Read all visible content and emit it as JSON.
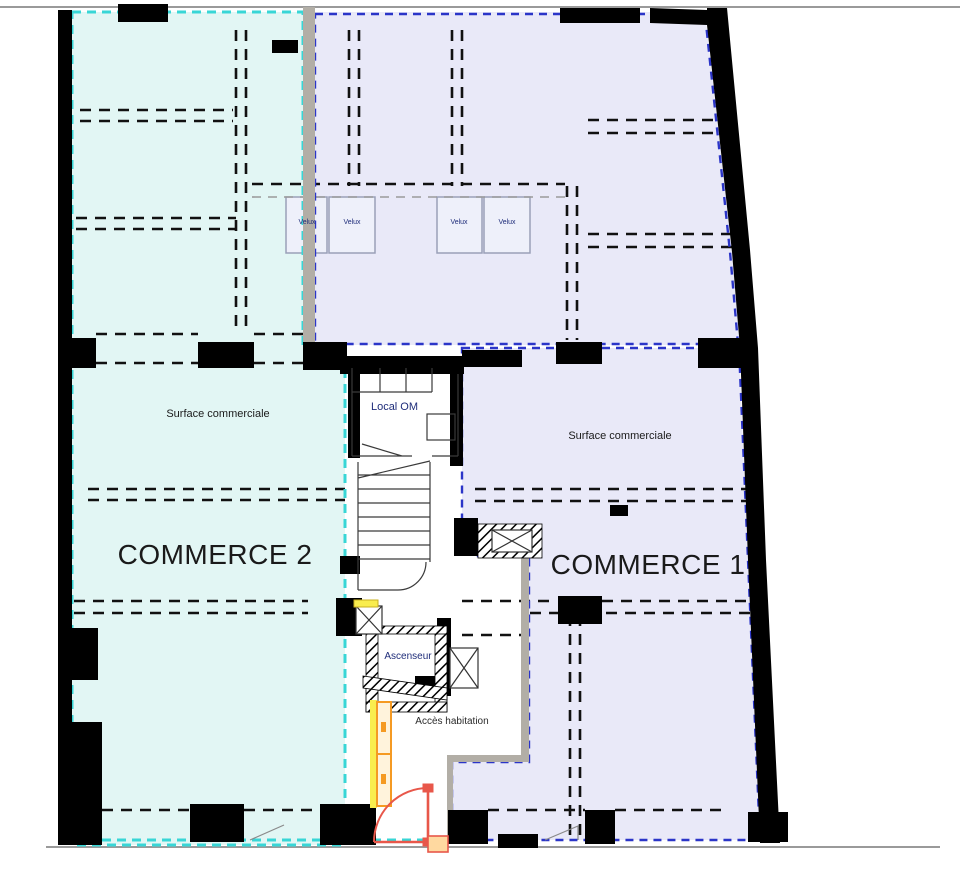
{
  "plan": {
    "zones": {
      "commerce2": {
        "label": "COMMERCE 2",
        "surface_label": "Surface commerciale",
        "fill": "#e2f6f4",
        "outline": "#38d6d6"
      },
      "commerce1": {
        "label": "COMMERCE 1",
        "surface_label": "Surface commerciale",
        "fill": "#e9e9f8",
        "outline": "#2b35c8"
      }
    },
    "core": {
      "local_om_label": "Local OM",
      "ascenseur_label": "Ascenseur",
      "acces_habitation_label": "Accès habitation"
    },
    "velux_label": "Velux",
    "colors": {
      "wall": "#000000",
      "gray_wall": "#b2aea6",
      "site_line": "#9a9a9a",
      "orange": "#f59a23",
      "yellow": "#f9ed4e",
      "door_red": "#e8574a",
      "navy_text": "#1f2d7a",
      "black_text": "#1a1a1a",
      "partition": "#111111"
    }
  }
}
